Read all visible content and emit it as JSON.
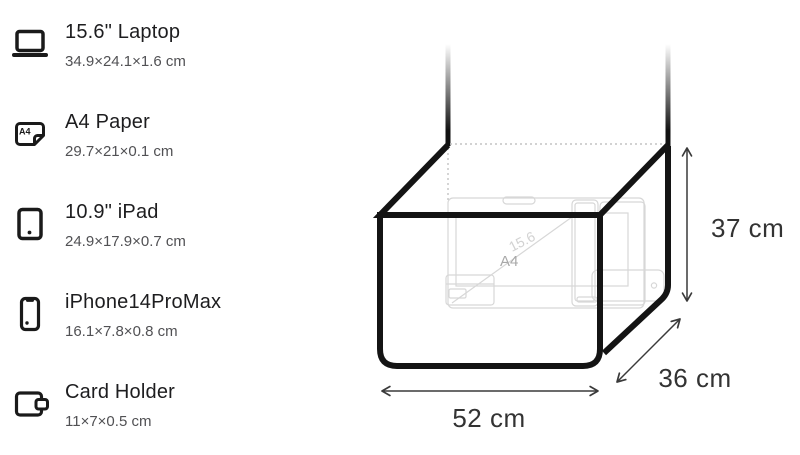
{
  "sidebar": {
    "items": [
      {
        "label": "15.6\" Laptop",
        "dimensions": "34.9×24.1×1.6 cm",
        "icon": "laptop-icon"
      },
      {
        "label": "A4 Paper",
        "dimensions": "29.7×21×0.1 cm",
        "icon": "a4-paper-icon"
      },
      {
        "label": "10.9\" iPad",
        "dimensions": "24.9×17.9×0.7 cm",
        "icon": "ipad-icon"
      },
      {
        "label": "iPhone14ProMax",
        "dimensions": "16.1×7.8×0.8 cm",
        "icon": "iphone-icon"
      },
      {
        "label": "Card Holder",
        "dimensions": "11×7×0.5 cm",
        "icon": "wallet-icon"
      }
    ],
    "a4_icon_label": "A4"
  },
  "diagram": {
    "width_label": "52 cm",
    "depth_label": "36 cm",
    "height_label": "37 cm",
    "ghost_labels": {
      "a4": "A4",
      "laptop_diagonal": "15.6"
    }
  },
  "colors": {
    "bag_outline": "#141414",
    "title_text": "#1d1d1f",
    "subtitle_text": "#515154",
    "dimension_text": "#333333",
    "ghost_outline": "#d7d7d7"
  }
}
